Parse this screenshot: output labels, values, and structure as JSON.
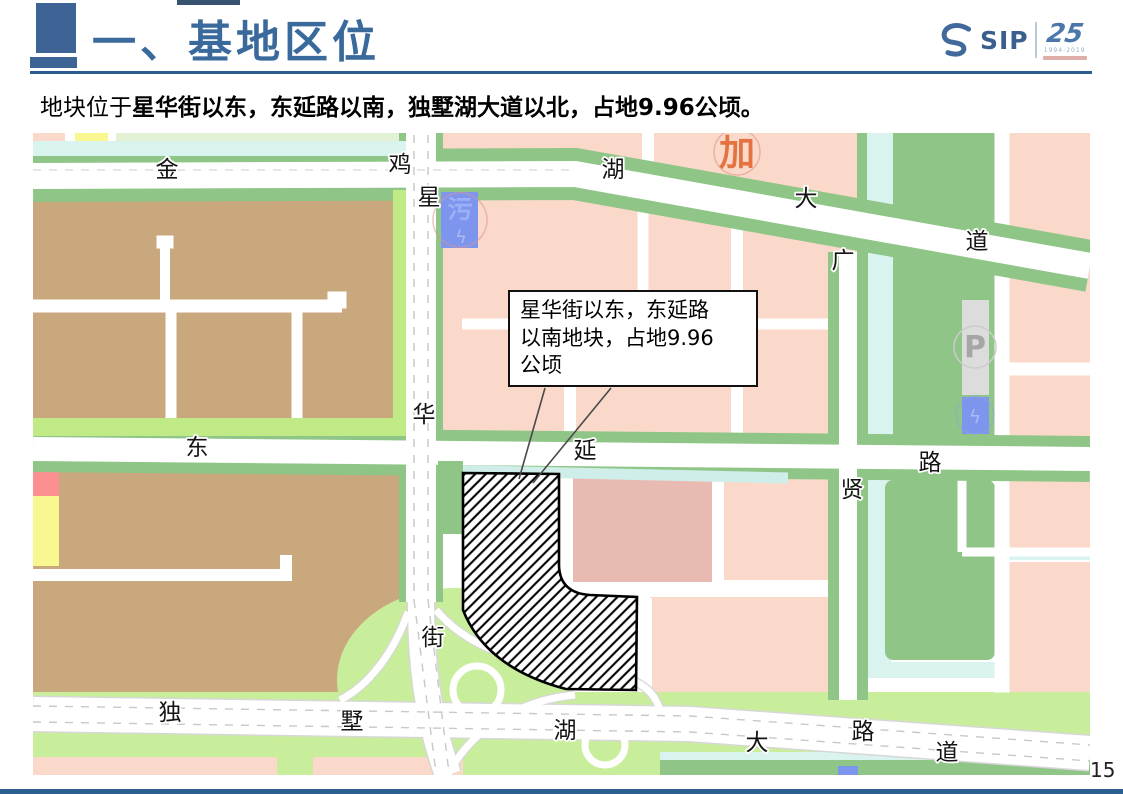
{
  "slide": {
    "title": "一、基地区位",
    "subtitle": {
      "prefix": "地块位于",
      "emphasis": "星华街以东，东延路以南，独墅湖大道以北，占地9.96公顷。"
    },
    "page_number": "15"
  },
  "logo": {
    "sip": "SIP",
    "anniversary": "25",
    "years": "1994-2019"
  },
  "callout": {
    "line1": "星华街以东，东延路",
    "line2": "以南地块，占地9.96",
    "line3": "公顷"
  },
  "map": {
    "roads": {
      "jinjihu": [
        "金",
        "鸡",
        "湖",
        "大",
        "道"
      ],
      "xinghua": [
        "星",
        "华",
        "街"
      ],
      "dongyan": [
        "东",
        "延",
        "路"
      ],
      "dushuhu": [
        "独",
        "墅",
        "湖",
        "大",
        "道"
      ],
      "guangxian": [
        "广",
        "贤",
        "路"
      ]
    },
    "markers": {
      "sewage": "污",
      "power": "ϟ",
      "parking": "P",
      "gas": "加"
    },
    "colors": {
      "title_blue": "#3a6a9c",
      "rule_blue": "#2c5c90",
      "bottom_bar_blue": "#2e5f93",
      "block_tan": "#c9a87e",
      "block_pink": "#fbd9ca",
      "block_mauve": "#e9bab2",
      "park_light_green": "#c9ee9b",
      "strip_green": "#8fc687",
      "canal_cyan": "#d9f4ef",
      "utility_blue": "#7e95ee",
      "parking_gray": "#dcdcdc",
      "gas_orange": "#e05a20",
      "alert_red": "#fc9090",
      "block_yellow": "#f9f78f",
      "site_hatch": "#000000"
    }
  }
}
